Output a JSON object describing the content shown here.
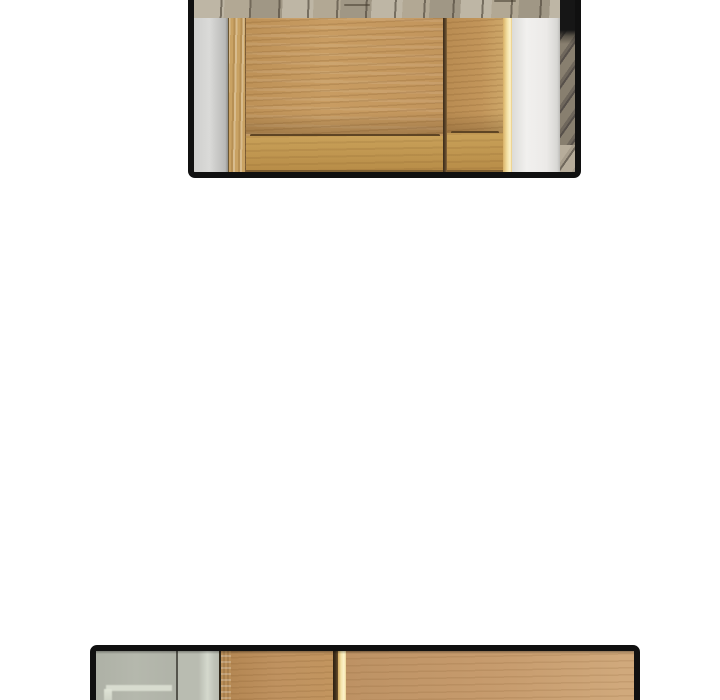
{
  "meta": {
    "kind": "webtoon comic page fragment",
    "text_content": "none (art-only panels, no dialogue or captions visible)"
  },
  "panels": {
    "top": {
      "alt": "Lower half of a light-oak interior door with a recessed panel and narrow right stile, grey wall at left, warm light along the door edge, white pillar and dark hallway with diagonal planks at right, pale wood-plank floor below"
    },
    "bottom": {
      "alt": "Thin top sliver of a scene: grey-green frosted glass partition with pale frame reflections at left, then light-oak cabinet doors separated by a dark gap with warm glowing light"
    }
  },
  "colors": {
    "ink": "#101010",
    "page-bg": "#ffffff",
    "wall-grey": "#cfcfcd",
    "wall-grey-dark": "#b9b9b7",
    "jamb-wood": "#c9a263",
    "door-wood": "#c89c62",
    "rail-wood": "#c9a159",
    "stile-wood": "#c2955a",
    "groove-brown": "#5f4524",
    "glow-gold": "#d8b066",
    "glow-light": "#fdf3cb",
    "wall-white": "#f1f0ee",
    "wall-white-shade": "#d8d7d4",
    "doorway-black": "#161616",
    "doorway-plank": "#887f6f",
    "doorway-plank-dark": "#57504a",
    "floor-base": "#b2a894",
    "glass-grey": "#b5b8ad",
    "glass-grey-2": "#b9bcb1",
    "glass-highlight": "#dfe3d6",
    "glass-seam": "#54544c",
    "cab-edge-wood": "#a8804e",
    "cab-wood-1": "#bf9260",
    "cab-wood-2": "#c79c6e",
    "cab-groove": "#42311d"
  }
}
